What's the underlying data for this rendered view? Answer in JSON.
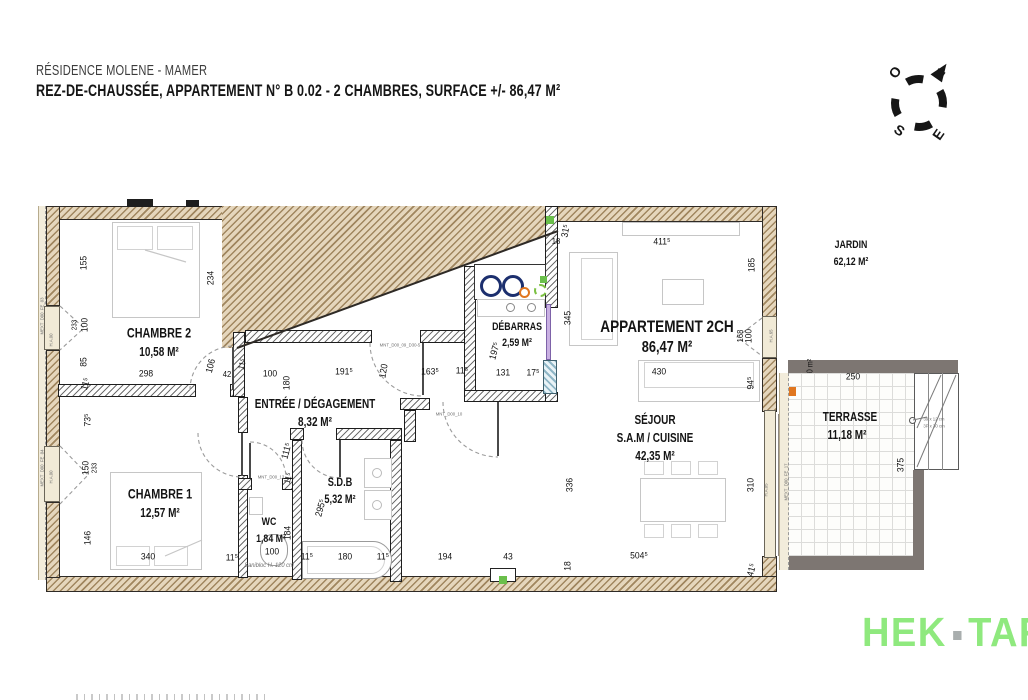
{
  "header": {
    "line1": "RÉSIDENCE MOLENE - MAMER",
    "line2": "REZ-DE-CHAUSSÉE, APPARTEMENT N° B 0.02 - 2 CHAMBRES, SURFACE +/- 86,47 M²"
  },
  "compass": {
    "n": "N",
    "e": "E",
    "s": "S",
    "o": "O"
  },
  "logo": {
    "left": "HEK",
    "right": "TAR"
  },
  "colors": {
    "logo_green": "#8fe97e",
    "wall_tan": "#e5d6bc",
    "terrace_gray": "#7d7672",
    "appliance_navy": "#1c2f6e",
    "appliance_orange": "#e0761f",
    "marker_green": "#6abf4b",
    "door_lavender": "#c9b0e2"
  },
  "room_labels": [
    {
      "t": "CHAMBRE 2",
      "x": 159,
      "y": 333,
      "s": 13.5
    },
    {
      "t": "10,58 M²",
      "x": 159,
      "y": 352,
      "s": 12.5
    },
    {
      "t": "CHAMBRE 1",
      "x": 160,
      "y": 494,
      "s": 13.5
    },
    {
      "t": "12,57 M²",
      "x": 160,
      "y": 513,
      "s": 12.5
    },
    {
      "t": "ENTRÉE / DÉGAGEMENT",
      "x": 315,
      "y": 404,
      "s": 12.5
    },
    {
      "t": "8,32 M²",
      "x": 315,
      "y": 422,
      "s": 12.5
    },
    {
      "t": "S.D.B",
      "x": 340,
      "y": 483,
      "s": 11.5
    },
    {
      "t": "5,32 M²",
      "x": 340,
      "y": 500,
      "s": 11.5
    },
    {
      "t": "WC",
      "x": 269,
      "y": 522,
      "s": 11
    },
    {
      "t": "1,84 M²",
      "x": 271,
      "y": 539,
      "s": 11
    },
    {
      "t": "DÉBARRAS",
      "x": 517,
      "y": 327,
      "s": 11
    },
    {
      "t": "2,59 M²",
      "x": 517,
      "y": 343,
      "s": 11
    },
    {
      "t": "APPARTEMENT 2CH",
      "x": 667,
      "y": 327,
      "s": 17
    },
    {
      "t": "86,47 M²",
      "x": 667,
      "y": 348,
      "s": 16
    },
    {
      "t": "SÉJOUR",
      "x": 655,
      "y": 420,
      "s": 12.5
    },
    {
      "t": "S.A.M / CUISINE",
      "x": 655,
      "y": 438,
      "s": 12.5
    },
    {
      "t": "42,35 M²",
      "x": 655,
      "y": 456,
      "s": 12.5
    },
    {
      "t": "JARDIN",
      "x": 851,
      "y": 245,
      "s": 11
    },
    {
      "t": "62,12 M²",
      "x": 851,
      "y": 262,
      "s": 11
    },
    {
      "t": "TERRASSE",
      "x": 850,
      "y": 417,
      "s": 12.5
    },
    {
      "t": "11,18 M²",
      "x": 847,
      "y": 435,
      "s": 12.5
    }
  ],
  "dims": [
    {
      "t": "155",
      "x": 84,
      "y": 263,
      "r": -90
    },
    {
      "t": "234",
      "x": 211,
      "y": 278,
      "r": -90
    },
    {
      "t": "100",
      "x": 85,
      "y": 325,
      "r": -90
    },
    {
      "t": "233",
      "x": 75,
      "y": 325,
      "r": -90,
      "s": 7
    },
    {
      "t": "85",
      "x": 84,
      "y": 362,
      "r": -90
    },
    {
      "t": "11⁵",
      "x": 86,
      "y": 384,
      "r": -75
    },
    {
      "t": "298",
      "x": 146,
      "y": 374
    },
    {
      "t": "106",
      "x": 211,
      "y": 366,
      "r": -75
    },
    {
      "t": "42",
      "x": 227,
      "y": 374,
      "s": 8.5
    },
    {
      "t": "11⁵",
      "x": 242,
      "y": 364,
      "r": -75,
      "s": 8.5
    },
    {
      "t": "100",
      "x": 270,
      "y": 374
    },
    {
      "t": "180",
      "x": 287,
      "y": 383,
      "r": -90
    },
    {
      "t": "191⁵",
      "x": 344,
      "y": 372
    },
    {
      "t": "120",
      "x": 384,
      "y": 371,
      "r": -80
    },
    {
      "t": "163⁵",
      "x": 430,
      "y": 372
    },
    {
      "t": "11⁵",
      "x": 462,
      "y": 371
    },
    {
      "t": "73⁵",
      "x": 88,
      "y": 420,
      "r": -90
    },
    {
      "t": "150",
      "x": 86,
      "y": 468,
      "r": -90
    },
    {
      "t": "233",
      "x": 95,
      "y": 468,
      "r": -90,
      "s": 7
    },
    {
      "t": "146",
      "x": 88,
      "y": 538,
      "r": -90
    },
    {
      "t": "340",
      "x": 148,
      "y": 557
    },
    {
      "t": "11⁵",
      "x": 232,
      "y": 558
    },
    {
      "t": "111⁵",
      "x": 287,
      "y": 451,
      "r": -75
    },
    {
      "t": "11⁵",
      "x": 288,
      "y": 478,
      "r": -75,
      "s": 8.5
    },
    {
      "t": "184",
      "x": 288,
      "y": 533,
      "r": -90
    },
    {
      "t": "100",
      "x": 272,
      "y": 552
    },
    {
      "t": "11⁵",
      "x": 307,
      "y": 557
    },
    {
      "t": "180",
      "x": 345,
      "y": 557
    },
    {
      "t": "11⁵",
      "x": 383,
      "y": 557
    },
    {
      "t": "295⁵",
      "x": 321,
      "y": 508,
      "r": -75
    },
    {
      "t": "194",
      "x": 445,
      "y": 557
    },
    {
      "t": "43",
      "x": 508,
      "y": 557
    },
    {
      "t": "18",
      "x": 568,
      "y": 566,
      "r": -90
    },
    {
      "t": "504⁵",
      "x": 639,
      "y": 556
    },
    {
      "t": "41⁵",
      "x": 752,
      "y": 570,
      "r": -75
    },
    {
      "t": "336",
      "x": 570,
      "y": 485,
      "r": -90
    },
    {
      "t": "310",
      "x": 751,
      "y": 485,
      "r": -90
    },
    {
      "t": "197⁵",
      "x": 495,
      "y": 351,
      "r": -75
    },
    {
      "t": "131",
      "x": 503,
      "y": 373
    },
    {
      "t": "17⁵",
      "x": 533,
      "y": 373
    },
    {
      "t": "31⁵",
      "x": 566,
      "y": 231,
      "r": -80
    },
    {
      "t": "18",
      "x": 556,
      "y": 241,
      "s": 8.5
    },
    {
      "t": "345",
      "x": 568,
      "y": 318,
      "r": -90
    },
    {
      "t": "411⁵",
      "x": 662,
      "y": 242
    },
    {
      "t": "185",
      "x": 752,
      "y": 265,
      "r": -90
    },
    {
      "t": "100",
      "x": 749,
      "y": 336,
      "r": -90
    },
    {
      "t": "168",
      "x": 740,
      "y": 336,
      "r": -90,
      "s": 8.5
    },
    {
      "t": "430",
      "x": 659,
      "y": 372
    },
    {
      "t": "94⁵",
      "x": 751,
      "y": 383,
      "r": -90
    },
    {
      "t": "250",
      "x": 853,
      "y": 377
    },
    {
      "t": "375",
      "x": 901,
      "y": 465,
      "r": -90
    },
    {
      "t": "0 m²",
      "x": 810,
      "y": 366,
      "r": -90,
      "s": 8
    }
  ],
  "tiny_labels": [
    {
      "t": "MNT_D00_09_D30-5",
      "x": 400,
      "y": 345
    },
    {
      "t": "MNT_D00_10",
      "x": 449,
      "y": 414
    },
    {
      "t": "MNT_D00_13",
      "x": 271,
      "y": 477
    },
    {
      "t": "Sanibloc H. 120 cm",
      "x": 269,
      "y": 566,
      "s": 6,
      "i": 1
    },
    {
      "t": "H.A.65",
      "x": 771,
      "y": 336,
      "r": -90
    },
    {
      "t": "H.A.00",
      "x": 51,
      "y": 340,
      "r": -90
    },
    {
      "t": "H.A.00",
      "x": 51,
      "y": 477,
      "r": -90
    },
    {
      "t": "H.A.05",
      "x": 766,
      "y": 490,
      "r": -90
    },
    {
      "t": "MEXT_D00_FE_03",
      "x": 42,
      "y": 316,
      "r": -90
    },
    {
      "t": "MEXT_D00_FE_04",
      "x": 42,
      "y": 468,
      "r": -90
    },
    {
      "t": "MEXT_D00_FE_17",
      "x": 786,
      "y": 482,
      "r": -90
    },
    {
      "t": "39 x 12 cm",
      "x": 934,
      "y": 419
    },
    {
      "t": "3P x 30 cm",
      "x": 934,
      "y": 426
    }
  ]
}
